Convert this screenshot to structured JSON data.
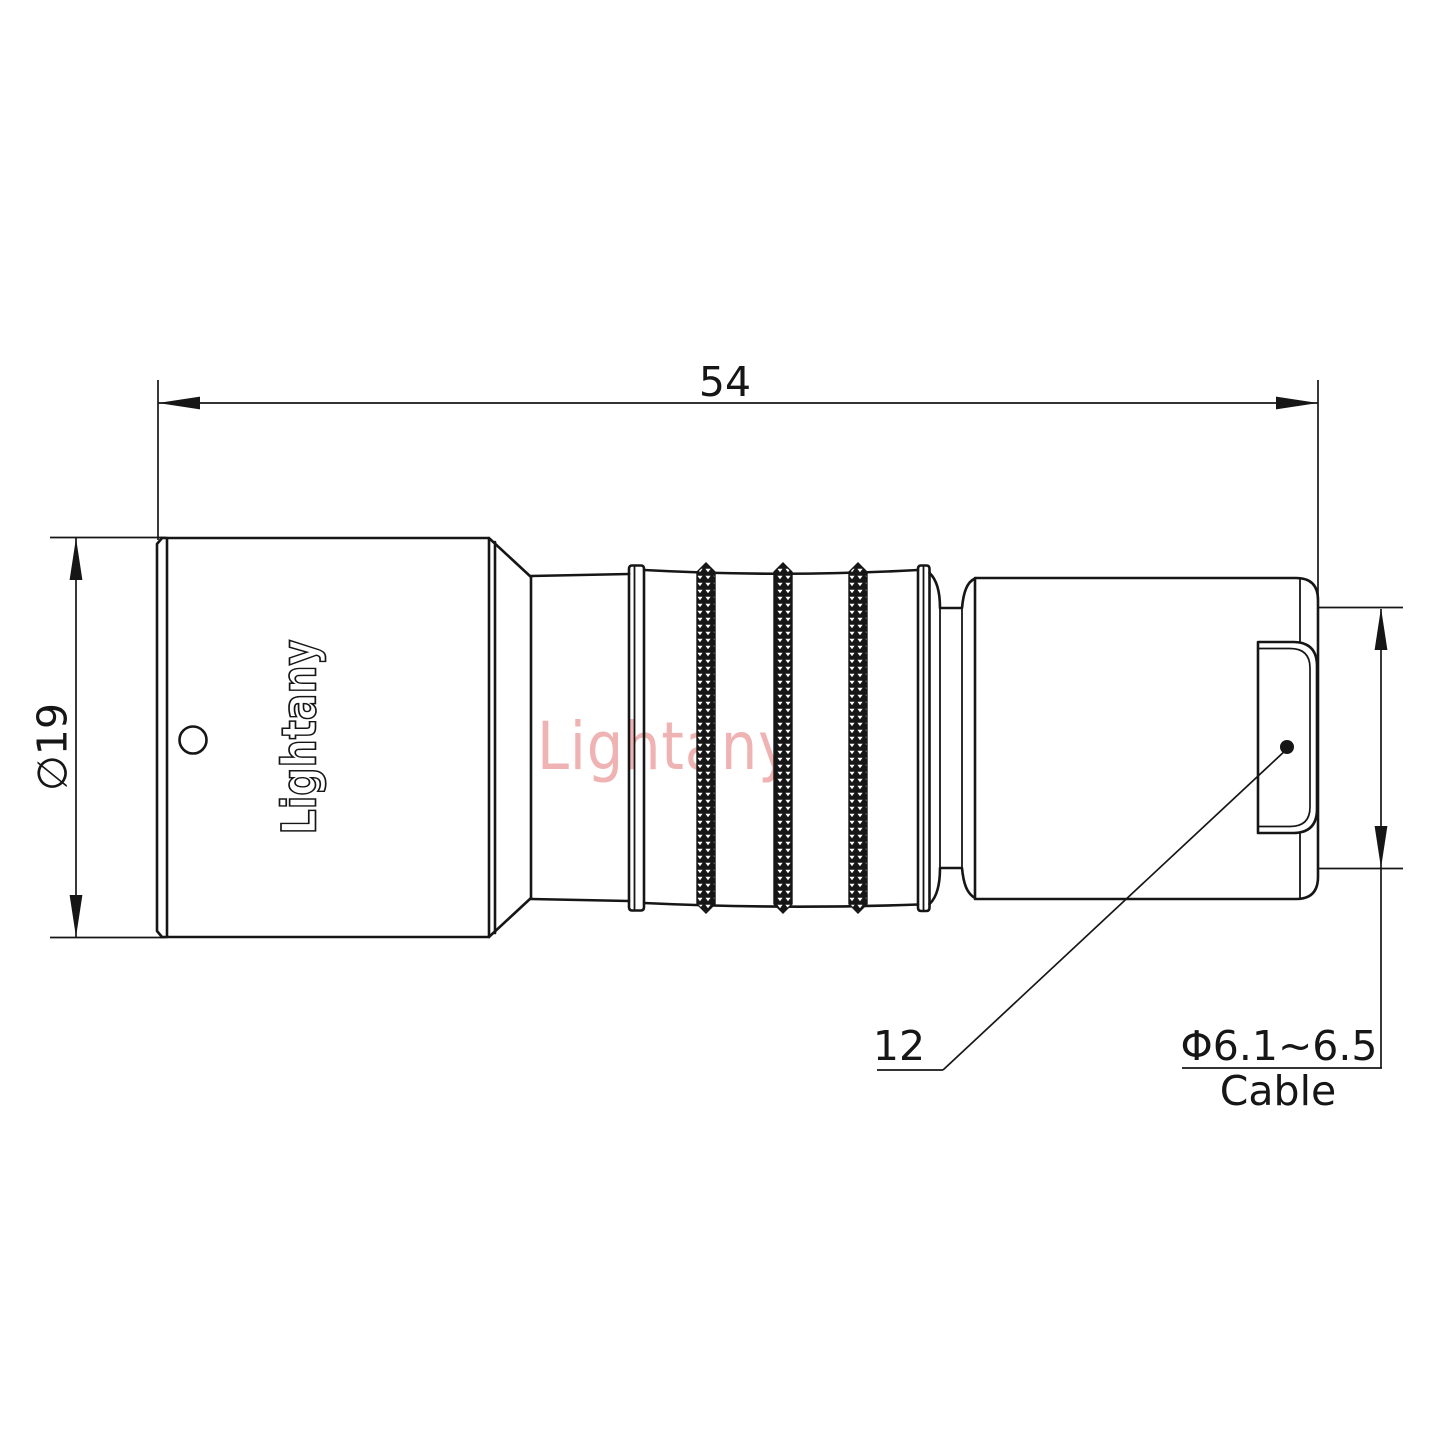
{
  "watermark": "Lightany",
  "connector": {
    "brand_engraving": "Lightany"
  },
  "dimensions": {
    "overall_length": "54",
    "front_diameter": "∅19",
    "rear_ref": "12",
    "cable_diameter": "Φ6.1~6.5",
    "cable_label": "Cable"
  },
  "colors": {
    "line": "#161616",
    "watermark_pink": "#efb3b3",
    "background": "#ffffff"
  }
}
